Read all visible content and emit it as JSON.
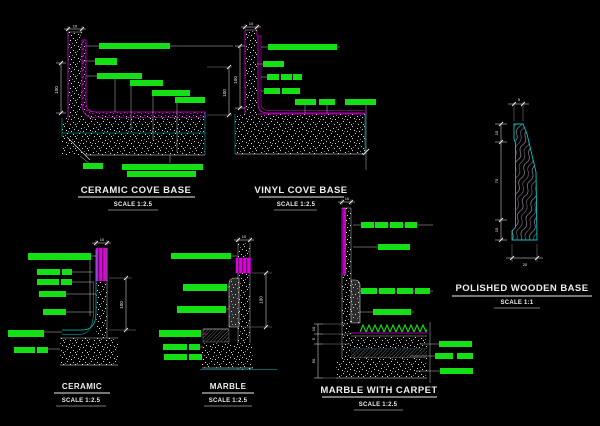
{
  "sheet": {
    "type": "CAD detail sheet",
    "background": "#000000"
  },
  "colors": {
    "green": "#15e015",
    "magenta": "#e000e0",
    "cyan": "#00c8c8",
    "white": "#ededed",
    "gray": "#9a9a9a",
    "background": "#000000"
  },
  "details": [
    {
      "id": "ceramic-cove-base",
      "title": "CERAMIC COVE BASE",
      "scale": "SCALE 1:2.5",
      "dims": {
        "left": "100",
        "right": "100",
        "wall": "10"
      },
      "label_bars": [
        [
          99,
          43,
          71,
          6
        ],
        [
          95,
          58,
          22,
          7
        ],
        [
          97,
          73,
          45,
          6
        ],
        [
          130,
          80,
          33,
          6
        ],
        [
          152,
          90,
          38,
          6
        ],
        [
          175,
          97,
          30,
          6
        ],
        [
          83,
          163,
          20,
          6
        ],
        [
          122,
          164,
          81,
          6
        ],
        [
          127,
          171,
          69,
          6
        ]
      ]
    },
    {
      "id": "vinyl-cove-base",
      "title": "VINYL COVE BASE",
      "scale": "SCALE 1:2.5",
      "dims": {
        "left": "100",
        "wall": "10"
      },
      "label_bars": [
        [
          268,
          44,
          69,
          6
        ],
        [
          263,
          61,
          21,
          6
        ],
        [
          267,
          74,
          12,
          6
        ],
        [
          281,
          74,
          11,
          6
        ],
        [
          293,
          74,
          9,
          6
        ],
        [
          264,
          88,
          16,
          6
        ],
        [
          282,
          88,
          18,
          6
        ],
        [
          295,
          99,
          21,
          6
        ],
        [
          319,
          99,
          16,
          6
        ],
        [
          345,
          99,
          31,
          6
        ]
      ]
    },
    {
      "id": "polished-wooden-base",
      "title": "POLISHED WOODEN BASE",
      "scale": "SCALE 1:1",
      "dims": {
        "top": "5",
        "upper": "15",
        "middle": "70",
        "lower": "15",
        "bottom": "20"
      },
      "label_bars": []
    },
    {
      "id": "ceramic",
      "title": "CERAMIC",
      "scale": "SCALE 1:2.5",
      "dims": {
        "right": "100",
        "wall": "10"
      },
      "label_bars": [
        [
          28,
          253,
          63,
          7
        ],
        [
          37,
          269,
          23,
          6
        ],
        [
          62,
          269,
          10,
          6
        ],
        [
          37,
          279,
          22,
          6
        ],
        [
          61,
          279,
          11,
          6
        ],
        [
          39,
          291,
          27,
          6
        ],
        [
          43,
          309,
          23,
          6
        ],
        [
          8,
          330,
          36,
          7
        ],
        [
          14,
          347,
          21,
          6
        ],
        [
          37,
          347,
          11,
          6
        ]
      ]
    },
    {
      "id": "marble",
      "title": "MARBLE",
      "scale": "SCALE 1:2.5",
      "dims": {
        "right": "100",
        "wall": "10"
      },
      "label_bars": [
        [
          171,
          253,
          60,
          6
        ],
        [
          183,
          284,
          44,
          7
        ],
        [
          177,
          306,
          49,
          7
        ],
        [
          159,
          330,
          42,
          7
        ],
        [
          163,
          344,
          24,
          6
        ],
        [
          189,
          344,
          11,
          6
        ],
        [
          164,
          354,
          23,
          6
        ],
        [
          189,
          354,
          13,
          6
        ]
      ]
    },
    {
      "id": "marble-with-carpet",
      "title": "MARBLE WITH CARPET",
      "scale": "SCALE 1:2.5",
      "dims": {
        "wall": "10",
        "carpet": "10",
        "screed": "5",
        "slab": "50"
      },
      "label_bars": [
        [
          361,
          222,
          13,
          6
        ],
        [
          375,
          222,
          13,
          6
        ],
        [
          390,
          222,
          13,
          6
        ],
        [
          405,
          222,
          12,
          6
        ],
        [
          378,
          244,
          32,
          6
        ],
        [
          361,
          288,
          16,
          6
        ],
        [
          379,
          288,
          16,
          6
        ],
        [
          397,
          288,
          16,
          6
        ],
        [
          415,
          288,
          15,
          6
        ],
        [
          373,
          309,
          38,
          6
        ],
        [
          439,
          341,
          33,
          6
        ],
        [
          435,
          353,
          18,
          6
        ],
        [
          457,
          353,
          16,
          6
        ],
        [
          440,
          368,
          33,
          6
        ]
      ]
    }
  ]
}
